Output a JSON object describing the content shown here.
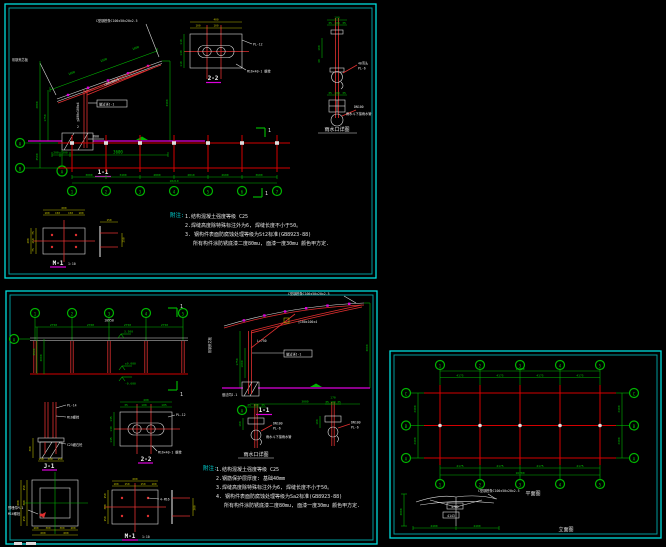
{
  "colors": {
    "background": "#000000",
    "border_cyan": "#00dcdc",
    "dim_green": "#00b400",
    "grid_red": "#d40000",
    "detail_white": "#dcdcdc",
    "underline_magenta": "#dc00dc",
    "dim_yellow": "#b4b400",
    "note_cyan": "#00dcdc"
  },
  "p1": {
    "sec": {
      "title": "1-1",
      "grid": "A",
      "dims_top": [
        "1000",
        "1500",
        "1000"
      ],
      "note_top": "C型钢檩条C100x50x20x2.5",
      "note_left": "彩钢夹芯板",
      "m_strut": "□80x80x4",
      "m_col": "□100x100x4",
      "note_box": "做法详J-1",
      "w1": "1",
      "w2": "2",
      "dim_l_in": "1750",
      "dim_l_out": "2800",
      "dim_r": "3300",
      "dims_bot": [
        "200",
        "300",
        "3600"
      ]
    },
    "d22": {
      "title": "2-2",
      "dims_top": [
        "100",
        "100"
      ],
      "dim_total": "400",
      "dims_left": [
        "110",
        "140",
        "110"
      ],
      "n1": "PL-12",
      "n2": "M16×40-1 螺栓"
    },
    "drain": {
      "title": "雨水口详图",
      "d1": "100",
      "d2": [
        "35",
        "100",
        "35"
      ],
      "d3": "160",
      "d4": "40",
      "n1": "40弯头",
      "n2": "PL-6",
      "d5": [
        "35",
        "100",
        "35"
      ],
      "n3": "DN100",
      "n4": "雨水斗下接雨水管"
    },
    "plan": {
      "rows": [
        "A",
        "B"
      ],
      "cols": [
        "1",
        "2",
        "3",
        "4",
        "5",
        "6",
        "7"
      ],
      "dim_row": "3500",
      "dim_small": "600",
      "dims": [
        "3000",
        "3400",
        "2800",
        "2810",
        "2600",
        "3600"
      ],
      "total": "18210",
      "cut": "1"
    },
    "m1": {
      "title": "M-1",
      "scale": "1:10",
      "top": [
        "100",
        "150",
        "150",
        "100"
      ],
      "top_total": "600",
      "left": [
        "75",
        "250",
        "75"
      ],
      "left_total": "400",
      "side_top": "150",
      "side_r": "250"
    },
    "notes": {
      "label": "附注:",
      "l1": "1.结构混凝土强度等级 C25",
      "l2": "2.焊缝高度除特殊标注外为6, 焊缝长度不小于50。",
      "l3": "3. 钢构件表面防腐蚀处理等级为St2标准(GB8923-88)",
      "l4": "所有构件涂防锈底漆二度80mu, 面漆一度30mu 颜色甲方定."
    }
  },
  "p2": {
    "strip": {
      "cols": [
        "1",
        "2",
        "3",
        "4",
        "5"
      ],
      "dims": [
        "2750",
        "2700",
        "2750",
        "2750"
      ],
      "total": "10950",
      "grid": "A",
      "dim_l1": "3000",
      "dim_l2": "3500",
      "lv1": "3.500",
      "lv2": "±0.000",
      "lv3": "-0.600",
      "cut": "1"
    },
    "sec": {
      "title": "1-1",
      "grid": "A",
      "note_top": "C型钢檩条C100x50x20x2.5",
      "note_left": "彩钢夹芯板",
      "member": "□100x100x4",
      "len": "L=750",
      "note_box": "做法详J-1",
      "foot": "做法同J-1",
      "dim_l": "1750",
      "dim_l2": "1000",
      "dim_r": "3000",
      "dim_bot": "3000"
    },
    "j1": {
      "title": "J-1",
      "n1": "PL-14",
      "n2": "M16螺栓",
      "n3": "C25细石砼",
      "dim_l": "300",
      "dims_bot": [
        "150",
        "300",
        "150"
      ]
    },
    "d22": {
      "title": "2-2",
      "dims_top": [
        "35",
        "100",
        "105"
      ],
      "dim_total": "400",
      "dims_left": [
        "135",
        "130",
        "135"
      ],
      "n1": "PL-12",
      "n2": "M16×40-1 螺栓"
    },
    "fplan": {
      "n1": "预埋件M-1",
      "n2": "M16螺栓",
      "left": [
        "150",
        "300",
        "150"
      ],
      "left_total": "600",
      "bot_small": [
        "200",
        "300",
        "300",
        "200"
      ],
      "bot_big": [
        "600",
        "600"
      ]
    },
    "m1": {
      "title": "M-1",
      "scale": "1:10",
      "top": [
        "100",
        "150",
        "150",
        "100"
      ],
      "top_total": "600",
      "left": [
        "150",
        "300",
        "150"
      ],
      "n1": "4-M16",
      "side_r": "300"
    },
    "drain1": {
      "title": "雨水口详图",
      "d2": [
        "35",
        "100",
        "35"
      ],
      "d3": "160",
      "n1": "DN100",
      "n2": "PL-6",
      "n3": "雨水斗下接雨水管"
    },
    "drain2": {
      "d0": "170",
      "d2": [
        "35",
        "100",
        "35"
      ],
      "d3": "160",
      "n1": "DN100",
      "n2": "PL-6"
    },
    "notes": {
      "label": "附注:",
      "l1": "1.结构混凝土强度等级 C25",
      "l2": "2.钢筋保护层厚度: 基础40mm",
      "l3": "3.焊缝高度除特殊标注外为6, 焊缝长度不小于50。",
      "l4": "4. 钢构件表面防腐蚀处理等级为Sa2标准(GB8923-88)",
      "l5": "所有构件涂防锈底漆二度80mu, 面漆一度30mu 颜色甲方定."
    }
  },
  "p3": {
    "plan": {
      "cols": [
        "1",
        "2",
        "3",
        "4",
        "5"
      ],
      "rows": [
        "C",
        "B",
        "A"
      ],
      "dims_h": [
        "4175",
        "4175",
        "4175",
        "4175"
      ],
      "total_h": "16700",
      "dims_v": [
        "2400",
        "2400"
      ],
      "label": "平面图"
    },
    "elev": {
      "dim_v": "3000",
      "dims_bot": [
        "2400",
        "2400"
      ],
      "v1": "4782",
      "v2": "4143",
      "note": "C型钢檩条C100x50x20x2.5",
      "label": "立面图"
    }
  }
}
